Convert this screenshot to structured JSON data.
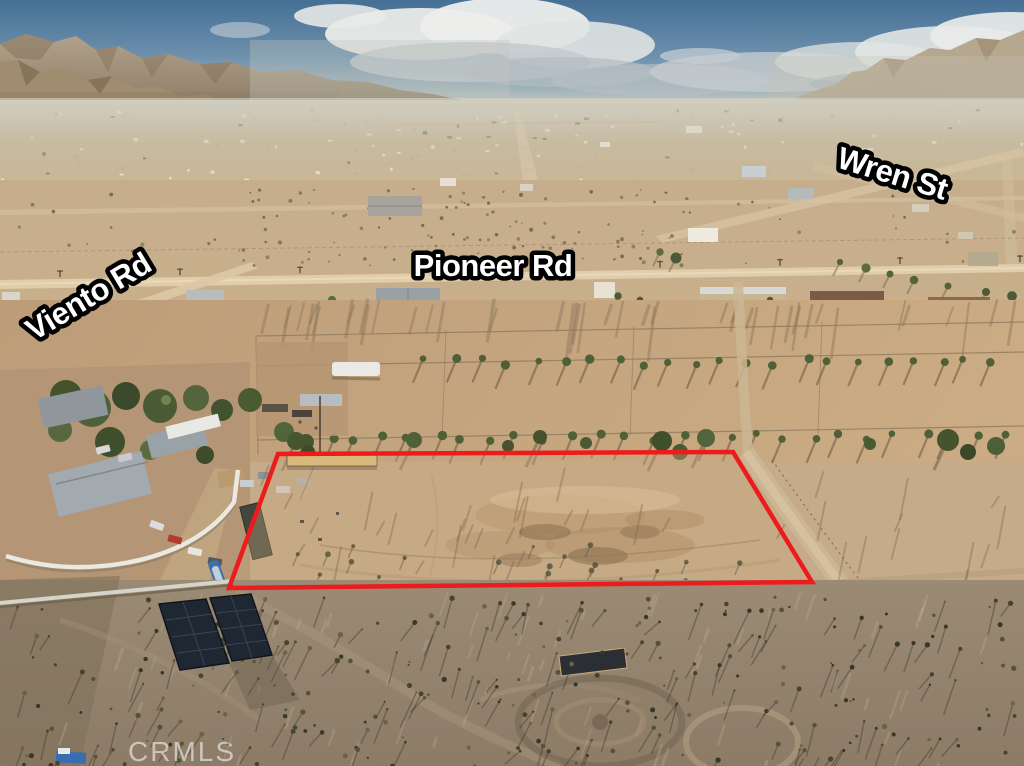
{
  "meta": {
    "description": "Aerial drone photo of a vacant desert land parcel outlined in red, in a rural high-desert community with mountains on the horizon"
  },
  "street_labels": {
    "wren": "Wren St",
    "pioneer": "Pioneer Rd",
    "viento": "Viento Rd"
  },
  "watermark": "CRMLS",
  "colors": {
    "parcel_boundary": "#ed1c1c",
    "label_fill": "#ffffff",
    "label_outline": "#000000",
    "watermark_fill": "#ffffff"
  }
}
